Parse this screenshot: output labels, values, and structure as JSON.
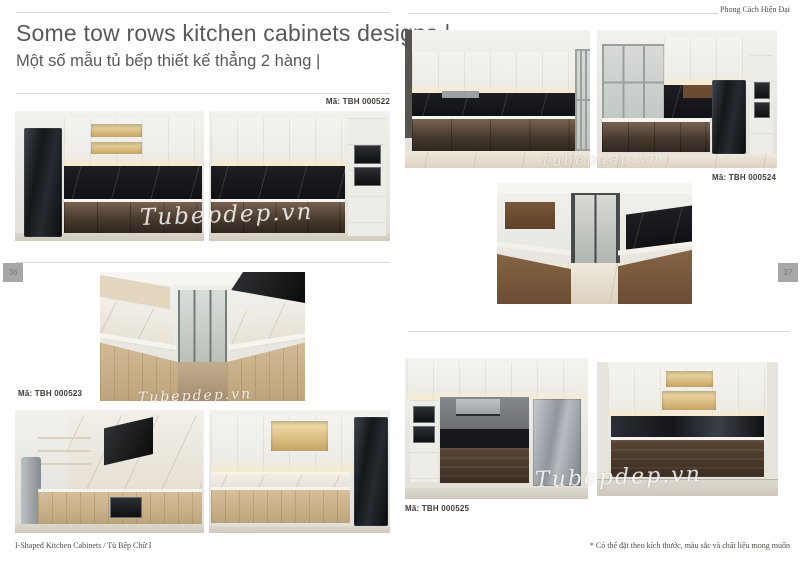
{
  "header": {
    "title_en": "Some tow rows kitchen cabinets designs |",
    "title_vi": "Một số mẫu tủ bếp thiết kế thẳng 2 hàng |",
    "style_tag": "Phong Cách Hiện Đại"
  },
  "page_numbers": {
    "left": "36",
    "right": "37"
  },
  "watermark": "Tubepdep.vn",
  "designs": [
    {
      "code": "Mã: TBH 000522"
    },
    {
      "code": "Mã: TBH 000523"
    },
    {
      "code": "Mã: TBH 000524"
    },
    {
      "code": "Mã: TBH 000525"
    }
  ],
  "footer": {
    "left": "I-Shaped Kitchen Cabinets  /  Tủ Bếp Chữ I",
    "right": "* Có thể đặt theo kích thước, màu sắc và chất liệu mong muốn"
  },
  "accent_colors": {
    "rule_gray": "#d9d9d9",
    "heading_gray": "#58595b",
    "tab_gray": "#a7a7a7"
  }
}
